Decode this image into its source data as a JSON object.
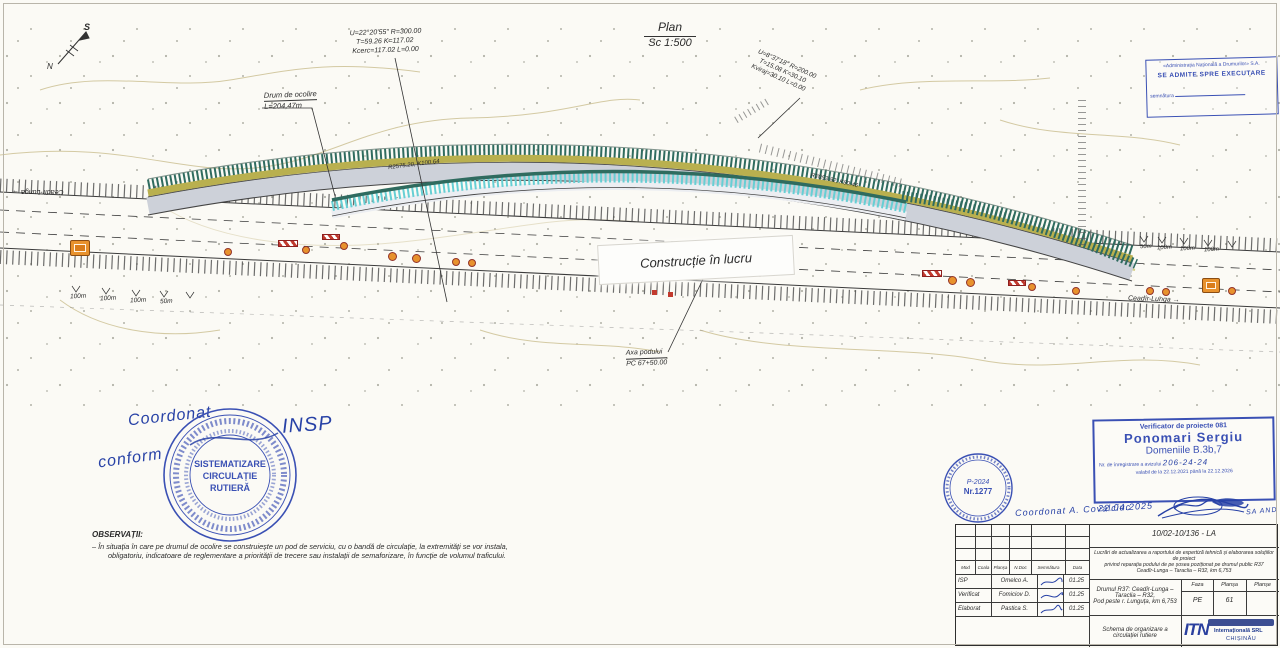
{
  "plan": {
    "title": "Plan",
    "scale": "Sc 1:500",
    "curve_left_1": "U=22°20'55\" R=300.00",
    "curve_left_2": "T=59.26 K=117.02",
    "curve_left_3": "Kcerc=117.02 L=0.00",
    "curve_right_1": "U=8°37'18\" R=200.00",
    "curve_right_2": "T=15.08 K=30.10",
    "curve_right_3": "Kviraj=30.10 L=0.00",
    "detour_label": "Drum de ocolire",
    "detour_length": "L=204,47m",
    "radius_left": "R2575.20, K100.64",
    "radius_right": "R2053.82, K80.46",
    "construction_label": "Construcție în lucru",
    "bridge_axis_1": "Axa podului",
    "bridge_axis_2": "PC 67+50.00",
    "direction_left": "Ceadîr-Lunga →",
    "direction_right": "Ceadîr-Lunga →",
    "compass_n": "N",
    "compass_s": "S",
    "distances_left": [
      "100m",
      "100m",
      "100m",
      "50m"
    ],
    "distances_right": [
      "50m",
      "100m",
      "100m",
      "100m"
    ]
  },
  "notes": {
    "heading": "OBSERVAȚII:",
    "line1": "– În situația în care pe drumul de ocolire se construiește un pod de serviciu, cu o bandă de circulație, la extremități se vor instala,",
    "line2": "obligatoriu, indicatoare de reglementare a priorității de trecere sau instalații de semaforizare, în funcție de volumul traficului."
  },
  "stamps": {
    "approval": {
      "line1": "«Administrația Națională a Drumurilor» S.A.",
      "line2": "SE ADMITE SPRE EXECUTARE",
      "line3": "semnătura"
    },
    "verifier": {
      "title": "Verificator de proiecte 081",
      "name": "Ponomari Sergiu",
      "domains": "Domeniile B.3b,7",
      "reg_label": "Nr. de înregistrare a avizului",
      "reg_value": "206-24-24",
      "validity": "valabil de la 22.12.2021 până la 22.12.2026",
      "hand_date": "22.04.2025"
    },
    "round_large": {
      "line1": "SISTEMATIZARE",
      "line2": "CIRCULAȚIE",
      "line3": "RUTIERĂ"
    },
    "round_small": {
      "line1": "P-2024",
      "line2": "Nr.1277"
    },
    "hand_left_1": "Coordonat",
    "hand_left_2": "conform",
    "hand_left_3": "INSP",
    "hand_right_1": "Coordonat  A. Covalciuc",
    "hand_right_2": "SA AND"
  },
  "title_block": {
    "doc_number": "10/02-10/136 - LA",
    "description": [
      "Lucrări de actualizarea a raportului de expertiză tehnică și elaborarea soluțiilor de proiect",
      "privind reparația podului de pe șosea poziționat pe drumul public R37",
      "Ceadîr-Lunga – Taraclia – R32, km 6,753"
    ],
    "columns": [
      "Mod",
      "Coala",
      "Planșa",
      "N.Doc",
      "Semnătura",
      "Data"
    ],
    "rows": [
      {
        "role": "ISP",
        "name": "Omelco A.",
        "date": "01.25"
      },
      {
        "role": "Verificat",
        "name": "Fomiciov D.",
        "date": "01.25"
      },
      {
        "role": "Elaborat",
        "name": "Pastica S.",
        "date": "01.25"
      }
    ],
    "object_1": "Drumul R37: Ceadîr-Lunga – Taraclia – R32,",
    "object_2": "Pod peste r. Lunguța, km 6,753",
    "phase_header": [
      "Faza",
      "Planșa",
      "Planșe"
    ],
    "phase_values": [
      "PE",
      "61",
      ""
    ],
    "sheet_title": "Schema de organizare a circulației rutiere",
    "logo": {
      "text": "ITN",
      "sub1": "Internațională SRL",
      "sub2": "CHIȘINĂU"
    }
  },
  "colors": {
    "stamp_blue": "#3a50b4",
    "handwriting_blue": "#2741a6",
    "sign_orange": "#e8922d",
    "embankment_teal": "#2f6b5f",
    "bridge_cyan": "#66cfd4",
    "shoulder_olive": "#b9b04f",
    "road_gray": "#cdd1d9",
    "contour_tan": "#cfc49a"
  }
}
